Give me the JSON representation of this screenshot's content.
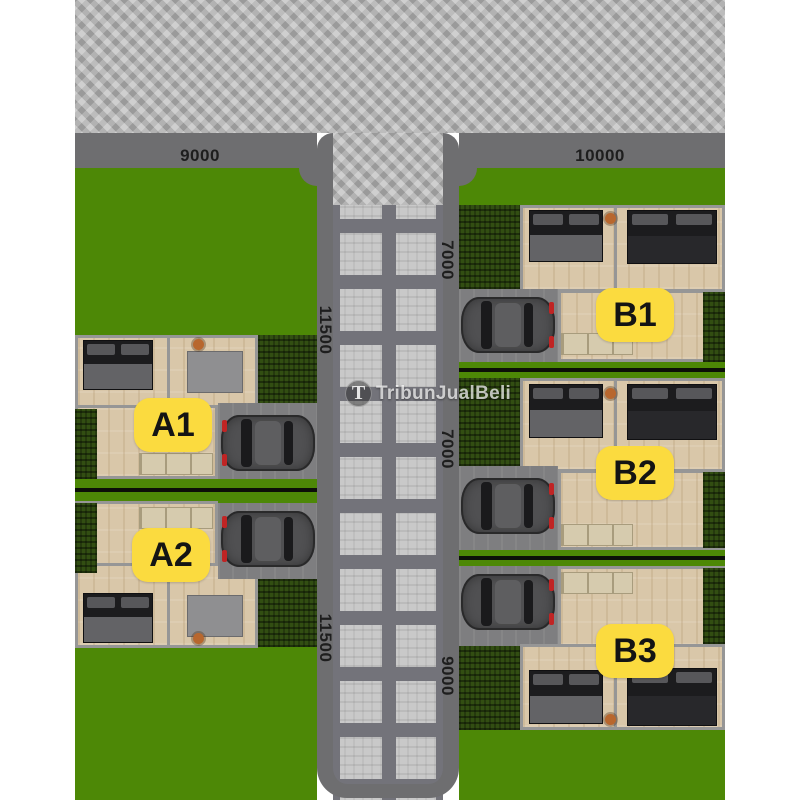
{
  "watermark": {
    "logo_letter": "T",
    "text": "TribunJualBeli"
  },
  "lots": [
    {
      "id": "A1"
    },
    {
      "id": "A2"
    },
    {
      "id": "B1"
    },
    {
      "id": "B2"
    },
    {
      "id": "B3"
    }
  ],
  "dimensions": [
    {
      "value": "9000",
      "position": "top-road-left"
    },
    {
      "value": "10000",
      "position": "top-road-right"
    },
    {
      "value": "7000",
      "position": "right-block-upper"
    },
    {
      "value": "11500",
      "position": "left-block-upper"
    },
    {
      "value": "7000",
      "position": "right-block-middle"
    },
    {
      "value": "11500",
      "position": "left-block-lower"
    },
    {
      "value": "9000",
      "position": "right-block-lower"
    }
  ],
  "colors": {
    "grass": "#4d8806",
    "hedge": "#324e12",
    "road_paving": "#b6b6b6",
    "sidewalk": "#6e6e70",
    "decorative_paving_light": "#c9c9c9",
    "decorative_paving_dark": "#73737a",
    "lot_label_bg": "#fbdb3f",
    "lot_label_text": "#141414",
    "floor_wood": "#d9c7a9",
    "wall": "#969696",
    "driveway": "#7e7e80",
    "car_body": "#505052",
    "dimension_text": "#1e1e1e"
  }
}
